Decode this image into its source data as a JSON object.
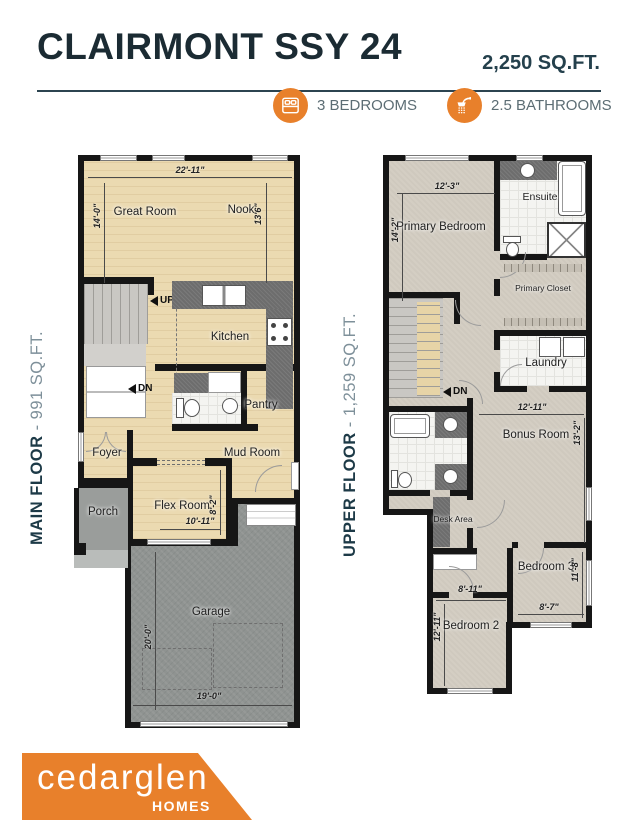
{
  "header": {
    "title": "CLAIRMONT SSY 24",
    "total_area": "2,250 SQ.FT.",
    "features": [
      {
        "icon": "bed-icon",
        "label": "3 BEDROOMS"
      },
      {
        "icon": "shower-icon",
        "label": "2.5 BATHROOMS"
      }
    ]
  },
  "main_floor": {
    "name": "MAIN FLOOR",
    "area": "- 991 SQ.FT.",
    "rooms": {
      "great_room": "Great Room",
      "nook": "Nook",
      "kitchen": "Kitchen",
      "pantry": "Pantry",
      "mud_room": "Mud Room",
      "foyer": "Foyer",
      "flex_room": "Flex Room",
      "porch": "Porch",
      "garage": "Garage"
    },
    "stairs": {
      "up": "UP",
      "down": "DN"
    },
    "dimensions": {
      "overall_width": "22'-11\"",
      "great_room_depth": "14'-0\"",
      "nook_depth": "13'6\"",
      "flex_width": "10'-11\"",
      "flex_depth": "8'-2\"",
      "garage_depth": "20'-0\"",
      "garage_width": "19'-0\""
    }
  },
  "upper_floor": {
    "name": "UPPER FLOOR",
    "area": "- 1,259 SQ.FT.",
    "rooms": {
      "primary_bedroom": "Primary Bedroom",
      "ensuite": "Ensuite",
      "primary_closet": "Primary Closet",
      "laundry": "Laundry",
      "bonus_room": "Bonus Room",
      "desk_area": "Desk Area",
      "bedroom_3": "Bedroom 3",
      "bedroom_2": "Bedroom 2"
    },
    "stairs": {
      "down": "DN"
    },
    "dimensions": {
      "primary_width": "12'-3\"",
      "primary_depth": "14'-2\"",
      "bonus_width": "12'-11\"",
      "bonus_depth": "13'-2\"",
      "bedroom3_depth": "11'-8\"",
      "bedroom3_width": "8'-7\"",
      "bedroom2_width": "8'-11\"",
      "bedroom2_depth": "12'-11\""
    }
  },
  "logo": {
    "brand": "cedarglen",
    "word": "HOMES"
  },
  "colors": {
    "accent_orange": "#E8802B",
    "heading_navy": "#1B2B33",
    "label_gray": "#5C6D74",
    "wood_floor": "#EBDAB1",
    "carpet": "#D4CEC3",
    "concrete": "#8F9391",
    "counter_gray": "#6D6D6D",
    "wall_black": "#161616"
  }
}
